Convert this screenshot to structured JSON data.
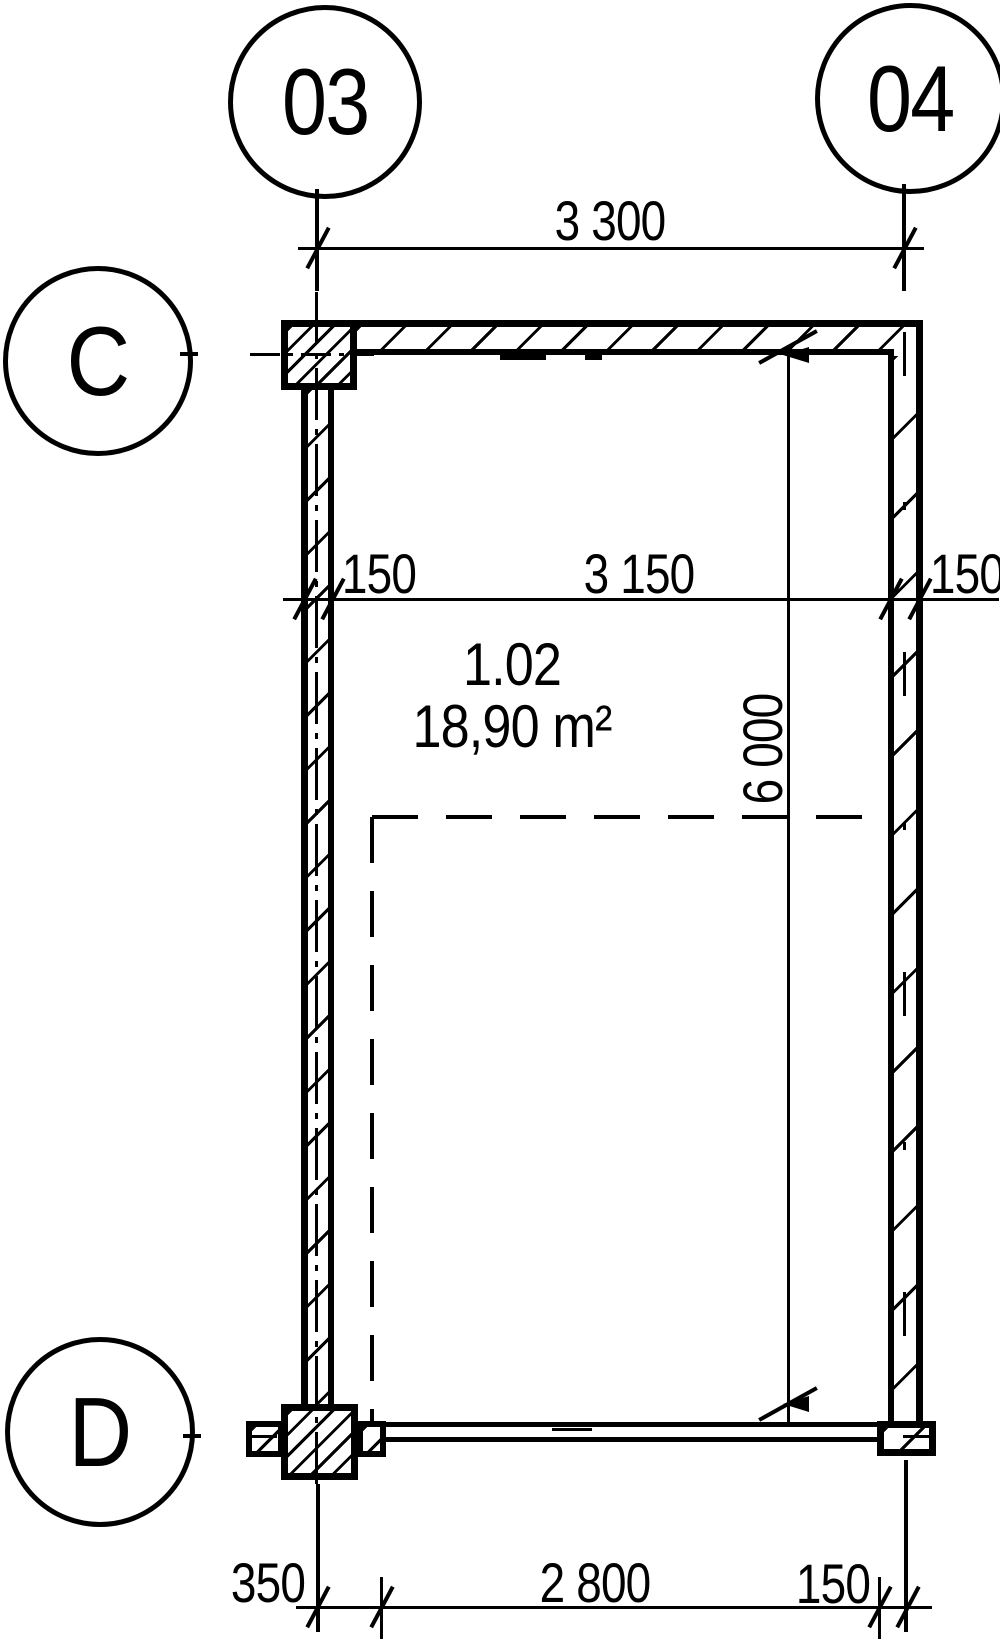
{
  "meta": {
    "background_color": "#ffffff",
    "line_color": "#000000",
    "drawing_type": "architectural floor plan fragment"
  },
  "grid": {
    "bubble_col_left": "03",
    "bubble_col_right": "04",
    "bubble_row_top": "C",
    "bubble_row_bottom": "D"
  },
  "dims": {
    "top_span": "3 300",
    "mid_left_thickness": "150",
    "mid_clear_width": "3 150",
    "mid_right_thickness": "150",
    "clear_height": "6 000",
    "bottom_left_offset": "350",
    "bottom_clear": "2 800",
    "bottom_right_thickness": "150"
  },
  "room": {
    "number": "1.02",
    "area": "18,90 m²"
  }
}
